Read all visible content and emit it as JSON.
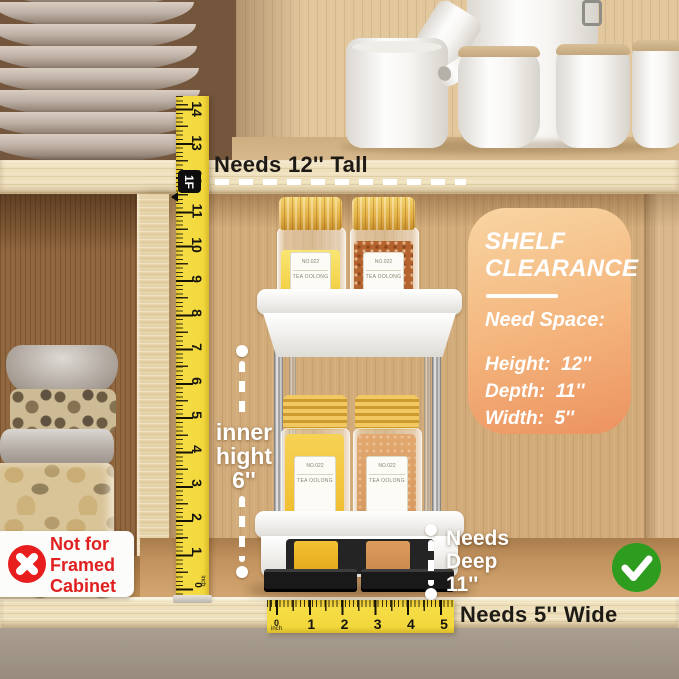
{
  "annotations": {
    "needs_tall": "Needs 12'' Tall",
    "needs_wide": "Needs 5'' Wide",
    "inner_height": [
      "inner",
      "hight",
      "6''"
    ],
    "needs_deep": [
      "Needs",
      "Deep",
      "11''"
    ],
    "not_for_framed": [
      "Not for",
      "Framed",
      "Cabinet"
    ]
  },
  "clearance_card": {
    "title": [
      "SHELF",
      "CLEARANCE"
    ],
    "subtitle": "Need Space:",
    "specs": [
      "Height:  12''",
      "Depth:  11''",
      "Width:  5''"
    ]
  },
  "rulers": {
    "vertical": {
      "numbers": [
        "14",
        "13",
        "12",
        "11",
        "10",
        "9",
        "8",
        "7",
        "6",
        "5",
        "4",
        "3",
        "2",
        "1",
        "0"
      ],
      "unit": "inch",
      "foot_marker": "1F"
    },
    "horizontal": {
      "numbers": [
        "0",
        "1",
        "2",
        "3",
        "4",
        "5"
      ],
      "unit": "inch"
    }
  },
  "spice_jar_label": {
    "number": "NO.022",
    "name": "TEA OOLONG"
  },
  "status_icons": {
    "approved": "green-check",
    "not_allowed": "red-cross"
  },
  "colors": {
    "ruler_yellow": "#f2d83c",
    "card_orange_start": "#f8d5a2",
    "card_orange_end": "#ec9260",
    "check_green": "#2e9c1f",
    "cross_red": "#e81d1d",
    "annotation_white": "#ffffff",
    "annotation_black": "#1e1b16"
  }
}
